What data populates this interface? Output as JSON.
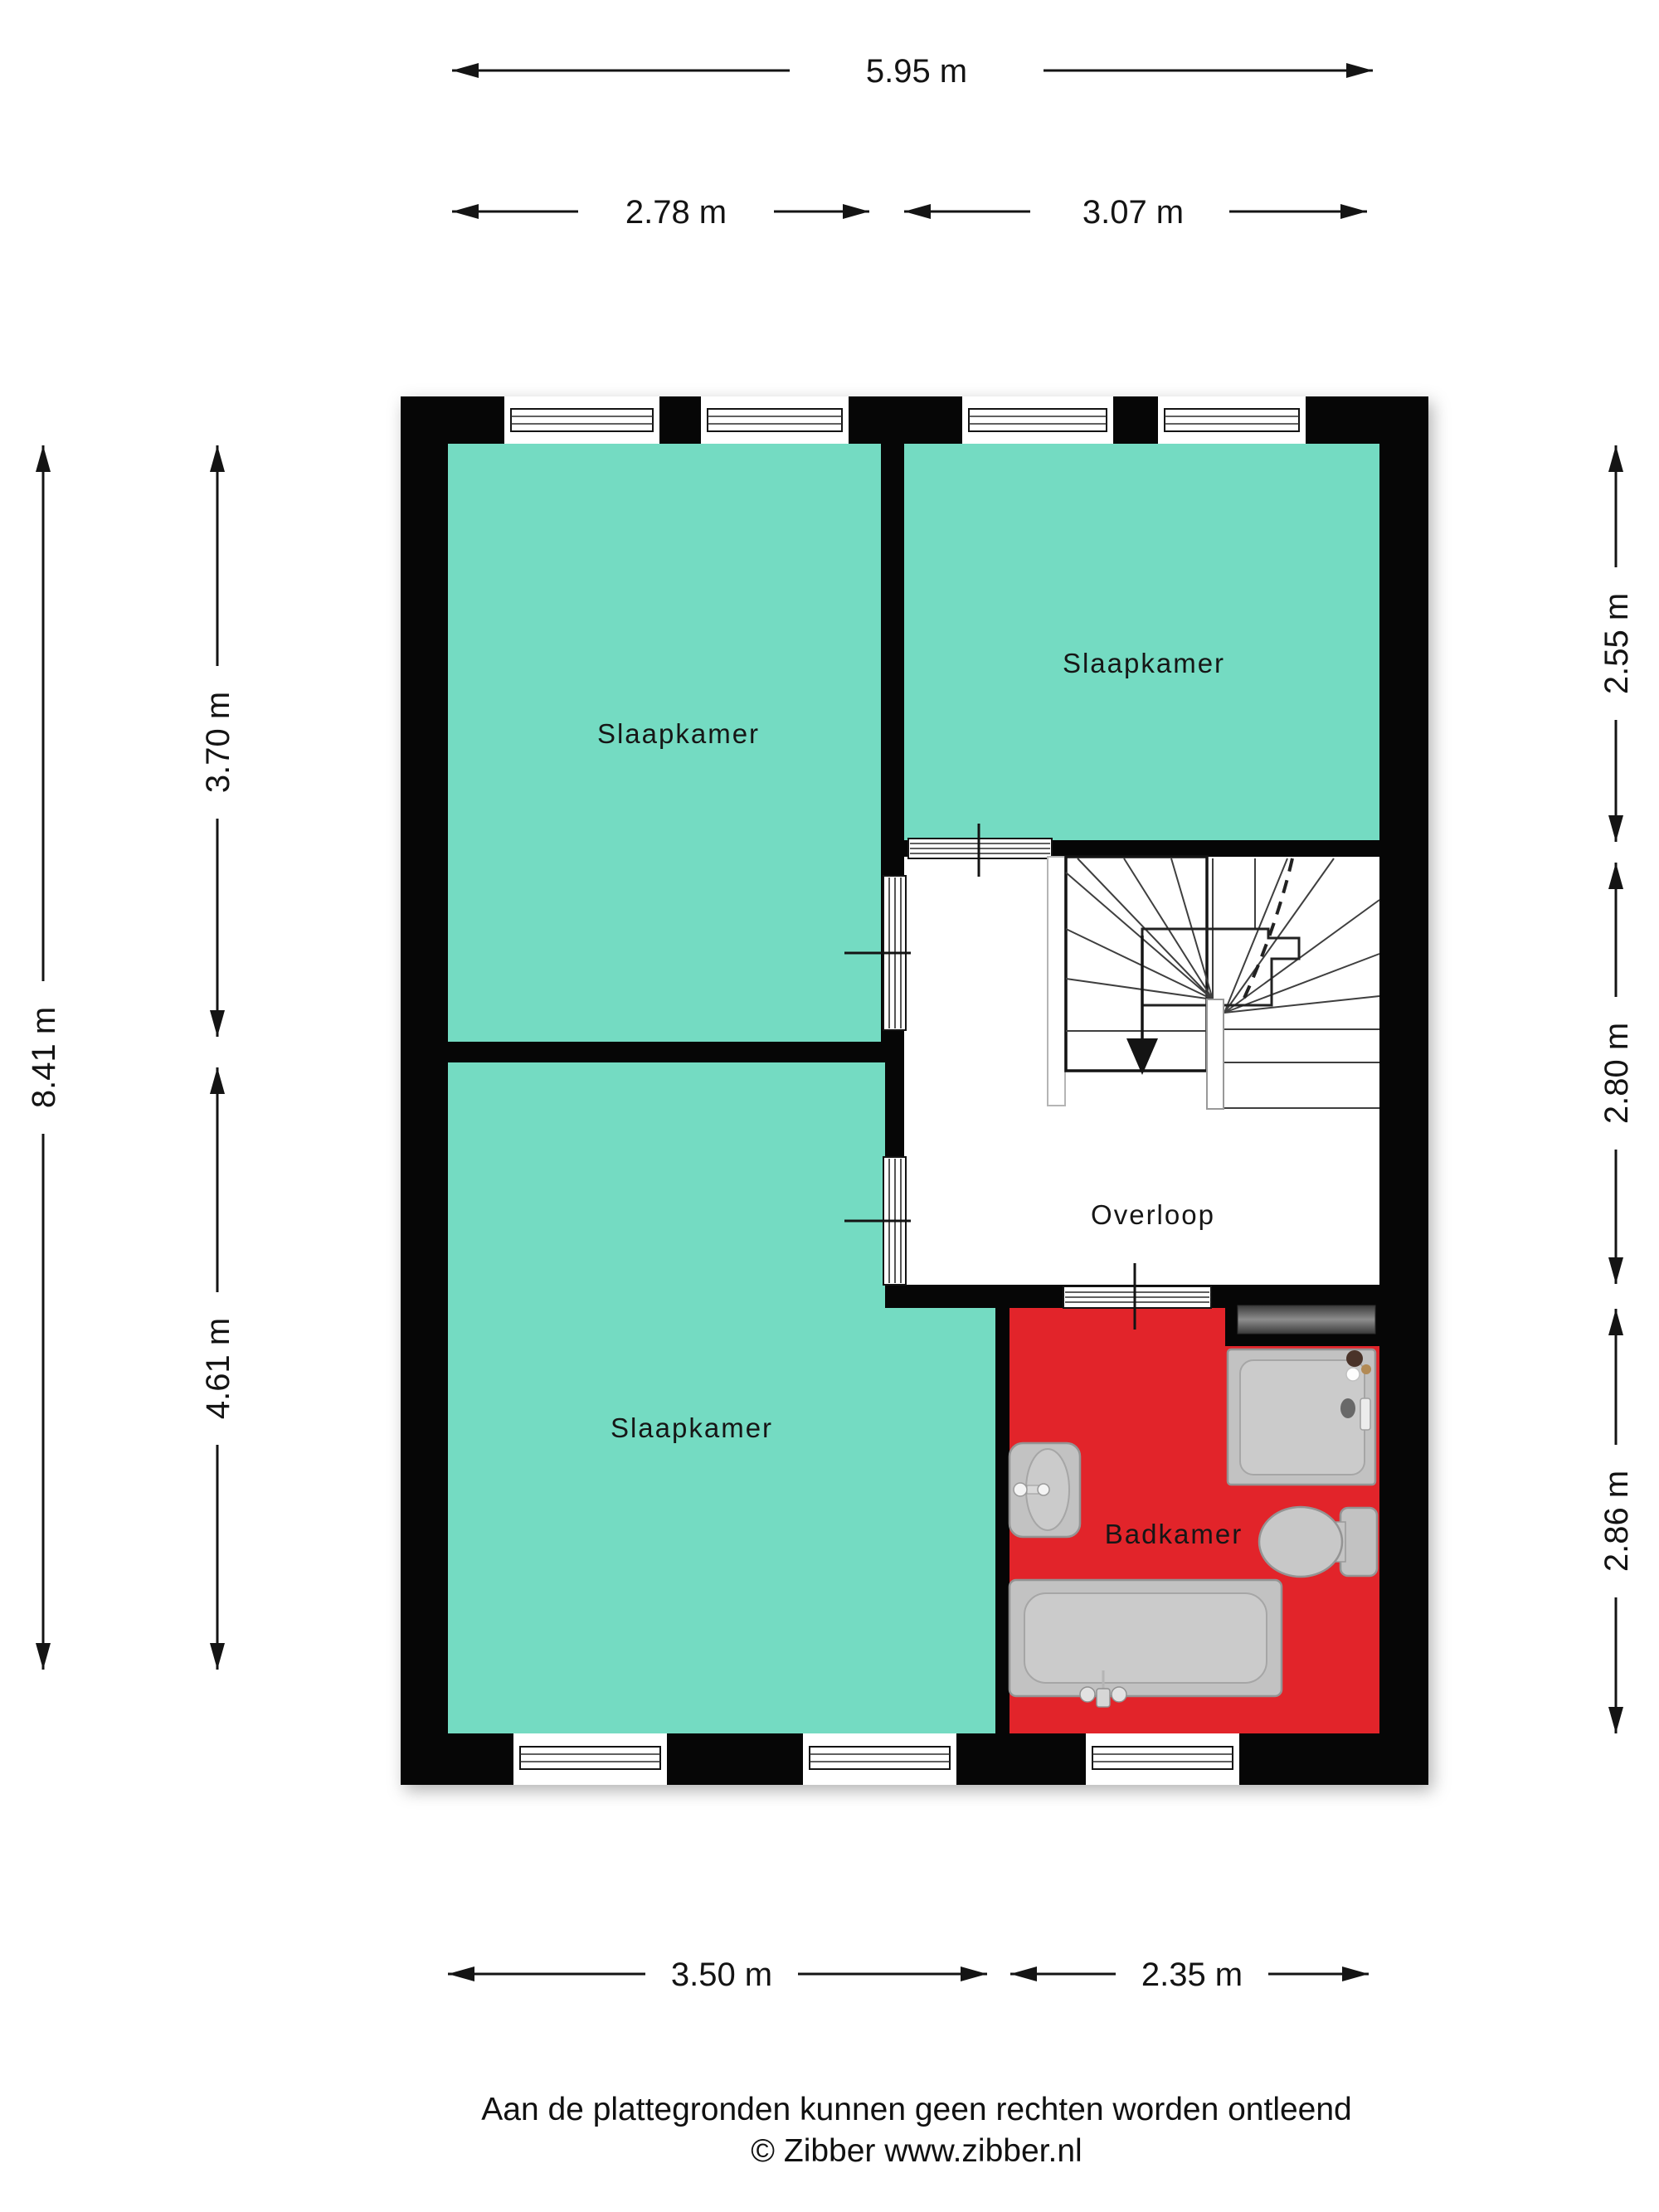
{
  "floorplan": {
    "type": "floor-plan",
    "colors": {
      "wall": "#060606",
      "bedroom_fill": "#74DBC2",
      "bathroom_fill": "#E2242A",
      "landing_fill": "#FFFFFF"
    },
    "rooms": {
      "slaapkamer_top_left": {
        "label": "Slaapkamer"
      },
      "slaapkamer_top_right": {
        "label": "Slaapkamer"
      },
      "slaapkamer_bottom": {
        "label": "Slaapkamer"
      },
      "overloop": {
        "label": "Overloop"
      },
      "badkamer": {
        "label": "Badkamer"
      }
    },
    "dimensions": {
      "top_total": "5.95 m",
      "top_segment_left": "2.78 m",
      "top_segment_right": "3.07 m",
      "left_total": "8.41 m",
      "left_segment_upper": "3.70 m",
      "left_segment_lower": "4.61 m",
      "right_segment_upper": "2.55 m",
      "right_segment_middle": "2.80 m",
      "right_segment_lower": "2.86 m",
      "bottom_segment_left": "3.50 m",
      "bottom_segment_right": "2.35 m"
    }
  },
  "footer": {
    "disclaimer": "Aan de plattegronden kunnen geen rechten worden ontleend",
    "credit": "© Zibber www.zibber.nl"
  }
}
